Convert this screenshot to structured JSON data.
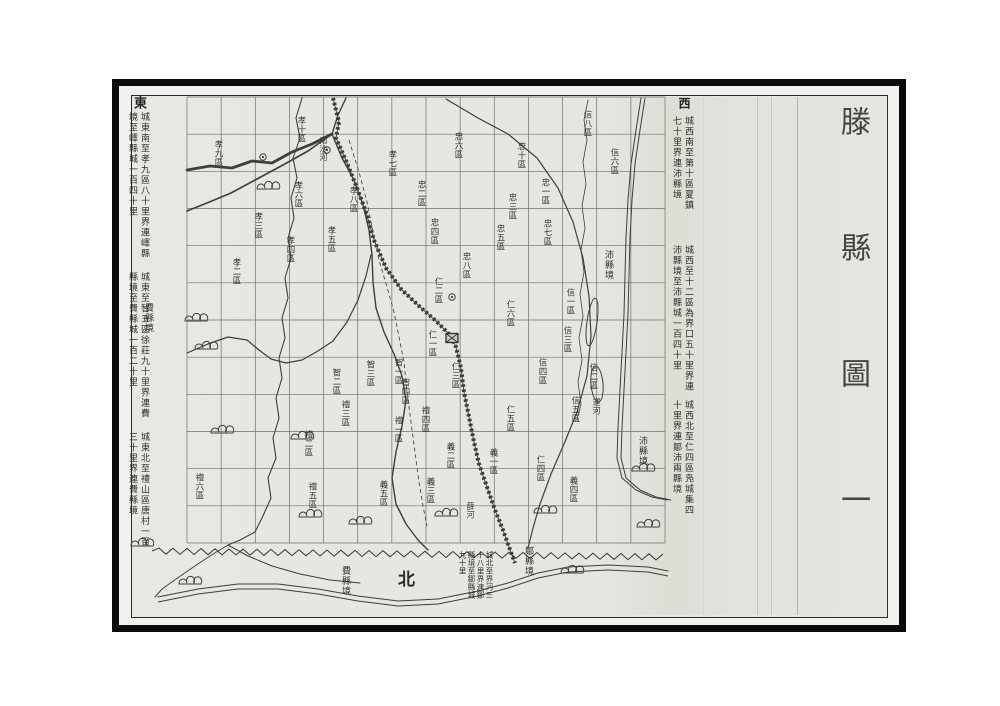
{
  "title": "滕縣圖一",
  "colors": {
    "paper": "#e8e6e1",
    "ink": "#3f3e3a",
    "grid": "#6f6e69",
    "frame": "#0b0b0b"
  },
  "margins": {
    "east": {
      "header": "東",
      "notes": [
        "城東南至孝九區八十里界連嶧縣境至嶧縣城一百四十里",
        "城東至智五區徐莊九十里界連費縣境至費縣城一百二十里",
        "城東北至禮山區唐村一百三十里界連費縣境"
      ]
    },
    "west": {
      "header": "西",
      "notes": [
        "城西南至第十區夏鎮七十里界連沛縣境",
        "城西至十二區為界口五十里界連沛縣境至沛縣城一百四十里",
        "城西北至仁四區凫城集四十里界連鄒沛兩縣境"
      ]
    }
  },
  "bottom": {
    "north": "北",
    "note": "城北至界河三十八里界連鄒縣境至鄒縣城九十里"
  },
  "map": {
    "grid": {
      "x0": 187,
      "y0": 97,
      "x1": 665,
      "y1": 543,
      "cols": 14,
      "rows": 12
    },
    "labels": {
      "district": [
        {
          "t": "孝十區",
          "x": 297,
          "y": 116
        },
        {
          "t": "孝九區",
          "x": 214,
          "y": 140
        },
        {
          "t": "孝六區",
          "x": 294,
          "y": 181
        },
        {
          "t": "孝三區",
          "x": 254,
          "y": 212
        },
        {
          "t": "孝四區",
          "x": 286,
          "y": 236
        },
        {
          "t": "孝八區",
          "x": 349,
          "y": 186
        },
        {
          "t": "孝七區",
          "x": 388,
          "y": 150
        },
        {
          "t": "孝五區",
          "x": 327,
          "y": 226
        },
        {
          "t": "孝二區",
          "x": 232,
          "y": 258
        },
        {
          "t": "忠六區",
          "x": 454,
          "y": 132
        },
        {
          "t": "忠十區",
          "x": 517,
          "y": 142
        },
        {
          "t": "忠二區",
          "x": 417,
          "y": 180
        },
        {
          "t": "忠一區",
          "x": 541,
          "y": 178
        },
        {
          "t": "忠三區",
          "x": 508,
          "y": 193
        },
        {
          "t": "忠四區",
          "x": 430,
          "y": 218
        },
        {
          "t": "忠五區",
          "x": 496,
          "y": 224
        },
        {
          "t": "忠七區",
          "x": 543,
          "y": 219
        },
        {
          "t": "忠八區",
          "x": 462,
          "y": 252
        },
        {
          "t": "信八區",
          "x": 583,
          "y": 110
        },
        {
          "t": "信六區",
          "x": 610,
          "y": 148
        },
        {
          "t": "信一區",
          "x": 566,
          "y": 288
        },
        {
          "t": "信三區",
          "x": 563,
          "y": 326
        },
        {
          "t": "信二區",
          "x": 589,
          "y": 363
        },
        {
          "t": "信四區",
          "x": 538,
          "y": 358
        },
        {
          "t": "信五區",
          "x": 571,
          "y": 396
        },
        {
          "t": "仁二區",
          "x": 434,
          "y": 277
        },
        {
          "t": "仁一區",
          "x": 428,
          "y": 330
        },
        {
          "t": "仁三區",
          "x": 451,
          "y": 362
        },
        {
          "t": "仁五區",
          "x": 506,
          "y": 405
        },
        {
          "t": "仁四區",
          "x": 536,
          "y": 455
        },
        {
          "t": "仁六區",
          "x": 506,
          "y": 300
        },
        {
          "t": "智一區",
          "x": 394,
          "y": 358
        },
        {
          "t": "智二區",
          "x": 332,
          "y": 368
        },
        {
          "t": "智三區",
          "x": 366,
          "y": 360
        },
        {
          "t": "智四區",
          "x": 401,
          "y": 378
        },
        {
          "t": "禮一區",
          "x": 394,
          "y": 416
        },
        {
          "t": "禮三區",
          "x": 341,
          "y": 400
        },
        {
          "t": "禮四區",
          "x": 421,
          "y": 406
        },
        {
          "t": "禮二區",
          "x": 304,
          "y": 430
        },
        {
          "t": "禮五區",
          "x": 308,
          "y": 482
        },
        {
          "t": "禮六區",
          "x": 195,
          "y": 473
        },
        {
          "t": "義一區",
          "x": 489,
          "y": 448
        },
        {
          "t": "義二區",
          "x": 446,
          "y": 442
        },
        {
          "t": "義三區",
          "x": 426,
          "y": 477
        },
        {
          "t": "義五區",
          "x": 379,
          "y": 480
        },
        {
          "t": "義四區",
          "x": 569,
          "y": 476
        }
      ],
      "place": [
        {
          "t": "南沙河",
          "x": 319,
          "y": 136
        },
        {
          "t": "運河",
          "x": 592,
          "y": 398
        },
        {
          "t": "薛河",
          "x": 466,
          "y": 502
        }
      ],
      "boundary": [
        {
          "t": "費縣境",
          "x": 144,
          "y": 303
        },
        {
          "t": "費縣境",
          "x": 341,
          "y": 566
        },
        {
          "t": "鄒縣境",
          "x": 524,
          "y": 546
        },
        {
          "t": "沛縣境",
          "x": 604,
          "y": 250
        },
        {
          "t": "沛縣境",
          "x": 638,
          "y": 436
        }
      ]
    },
    "rivers": [
      {
        "name": "east-wavy-river",
        "w": 1.1,
        "pts": [
          [
            302,
            98
          ],
          [
            296,
            118
          ],
          [
            300,
            138
          ],
          [
            293,
            158
          ],
          [
            297,
            178
          ],
          [
            291,
            198
          ],
          [
            294,
            218
          ],
          [
            288,
            238
          ],
          [
            291,
            258
          ],
          [
            285,
            278
          ],
          [
            288,
            298
          ],
          [
            282,
            318
          ],
          [
            285,
            338
          ],
          [
            279,
            358
          ],
          [
            282,
            378
          ],
          [
            276,
            398
          ],
          [
            279,
            418
          ],
          [
            273,
            438
          ],
          [
            276,
            458
          ],
          [
            268,
            478
          ],
          [
            271,
            498
          ],
          [
            262,
            518
          ],
          [
            255,
            532
          ],
          [
            240,
            540
          ],
          [
            228,
            545
          ]
        ]
      },
      {
        "name": "dark-top-river",
        "w": 2.8,
        "pts": [
          [
            187,
            170
          ],
          [
            210,
            166
          ],
          [
            232,
            168
          ],
          [
            252,
            161
          ],
          [
            272,
            163
          ],
          [
            292,
            152
          ],
          [
            312,
            144
          ],
          [
            332,
            134
          ]
        ]
      },
      {
        "name": "sw-branch",
        "w": 1.6,
        "pts": [
          [
            332,
            134
          ],
          [
            308,
            151
          ],
          [
            283,
            165
          ],
          [
            257,
            179
          ],
          [
            231,
            193
          ],
          [
            207,
            203
          ],
          [
            187,
            211
          ]
        ]
      },
      {
        "name": "top-entry",
        "w": 1.4,
        "pts": [
          [
            346,
            98
          ],
          [
            338,
            115
          ],
          [
            332,
            134
          ]
        ]
      },
      {
        "name": "main-south-river",
        "w": 1.4,
        "pts": [
          [
            332,
            134
          ],
          [
            342,
            158
          ],
          [
            354,
            180
          ],
          [
            363,
            205
          ],
          [
            369,
            230
          ],
          [
            372,
            255
          ],
          [
            373,
            282
          ],
          [
            376,
            308
          ],
          [
            384,
            332
          ],
          [
            394,
            354
          ],
          [
            402,
            376
          ],
          [
            406,
            400
          ],
          [
            402,
            426
          ],
          [
            396,
            452
          ],
          [
            392,
            478
          ],
          [
            396,
            504
          ],
          [
            406,
            524
          ],
          [
            418,
            540
          ],
          [
            428,
            550
          ]
        ]
      },
      {
        "name": "mid-horizontal-river",
        "w": 1.2,
        "pts": [
          [
            187,
            353
          ],
          [
            208,
            344
          ],
          [
            228,
            337
          ],
          [
            247,
            340
          ],
          [
            259,
            350
          ],
          [
            271,
            359
          ],
          [
            286,
            363
          ],
          [
            302,
            360
          ],
          [
            318,
            351
          ],
          [
            333,
            341
          ],
          [
            347,
            322
          ],
          [
            358,
            300
          ],
          [
            366,
            276
          ],
          [
            371,
            255
          ]
        ]
      },
      {
        "name": "big-right-curve",
        "w": 1.2,
        "pts": [
          [
            446,
            99
          ],
          [
            478,
            118
          ],
          [
            508,
            134
          ],
          [
            537,
            158
          ],
          [
            558,
            188
          ],
          [
            573,
            222
          ],
          [
            583,
            258
          ],
          [
            589,
            296
          ],
          [
            591,
            336
          ],
          [
            587,
            376
          ],
          [
            577,
            412
          ],
          [
            564,
            444
          ],
          [
            551,
            474
          ],
          [
            540,
            504
          ],
          [
            533,
            528
          ],
          [
            528,
            548
          ]
        ]
      },
      {
        "name": "canal",
        "w": 1.0,
        "double": 4,
        "pts": [
          [
            641,
            98
          ],
          [
            636,
            130
          ],
          [
            631,
            164
          ],
          [
            628,
            200
          ],
          [
            626,
            238
          ],
          [
            625,
            276
          ],
          [
            624,
            314
          ],
          [
            622,
            352
          ],
          [
            620,
            390
          ],
          [
            618,
            428
          ],
          [
            617,
            458
          ],
          [
            622,
            478
          ],
          [
            636,
            490
          ],
          [
            652,
            497
          ],
          [
            667,
            500
          ]
        ]
      },
      {
        "name": "lake-shore",
        "w": 0.8,
        "pts": [
          [
            588,
            100
          ],
          [
            584,
            120
          ],
          [
            587,
            140
          ],
          [
            583,
            162
          ],
          [
            586,
            184
          ],
          [
            582,
            206
          ],
          [
            585,
            228
          ],
          [
            581,
            250
          ],
          [
            584,
            272
          ],
          [
            580,
            294
          ],
          [
            583,
            316
          ],
          [
            579,
            338
          ],
          [
            582,
            360
          ],
          [
            578,
            382
          ],
          [
            581,
            404
          ],
          [
            577,
            420
          ]
        ]
      },
      {
        "name": "border-river",
        "w": 1.0,
        "double": 5,
        "pts": [
          [
            158,
            597
          ],
          [
            198,
            589
          ],
          [
            238,
            584
          ],
          [
            278,
            584
          ],
          [
            318,
            589
          ],
          [
            358,
            596
          ],
          [
            398,
            601
          ],
          [
            438,
            599
          ],
          [
            478,
            591
          ],
          [
            508,
            583
          ],
          [
            538,
            573
          ],
          [
            568,
            567
          ],
          [
            608,
            565
          ],
          [
            648,
            567
          ],
          [
            668,
            571
          ]
        ]
      },
      {
        "name": "fork-west",
        "w": 1.0,
        "pts": [
          [
            228,
            545
          ],
          [
            210,
            556
          ],
          [
            192,
            568
          ],
          [
            176,
            579
          ],
          [
            162,
            589
          ],
          [
            155,
            597
          ]
        ]
      },
      {
        "name": "fork-east",
        "w": 1.0,
        "pts": [
          [
            228,
            545
          ],
          [
            248,
            556
          ],
          [
            272,
            566
          ],
          [
            300,
            574
          ],
          [
            330,
            580
          ],
          [
            360,
            583
          ]
        ]
      }
    ],
    "railway": [
      [
        333,
        98
      ],
      [
        339,
        122
      ],
      [
        336,
        138
      ],
      [
        347,
        163
      ],
      [
        357,
        188
      ],
      [
        366,
        212
      ],
      [
        374,
        240
      ],
      [
        386,
        268
      ],
      [
        401,
        289
      ],
      [
        419,
        306
      ],
      [
        436,
        321
      ],
      [
        449,
        334
      ],
      [
        456,
        347
      ],
      [
        461,
        368
      ],
      [
        464,
        392
      ],
      [
        469,
        417
      ],
      [
        474,
        442
      ],
      [
        479,
        464
      ],
      [
        487,
        487
      ],
      [
        495,
        510
      ],
      [
        503,
        530
      ],
      [
        509,
        547
      ],
      [
        515,
        563
      ]
    ],
    "road": [
      [
        349,
        140
      ],
      [
        359,
        172
      ],
      [
        367,
        202
      ],
      [
        373,
        232
      ],
      [
        379,
        260
      ],
      [
        387,
        287
      ],
      [
        394,
        312
      ],
      [
        399,
        337
      ],
      [
        404,
        362
      ],
      [
        407,
        392
      ],
      [
        411,
        422
      ],
      [
        415,
        452
      ],
      [
        419,
        482
      ],
      [
        423,
        506
      ],
      [
        427,
        526
      ]
    ],
    "zigzag": {
      "x0": 152,
      "y0": 551,
      "x1": 668,
      "y1": 557,
      "step": 7,
      "amp": 3
    },
    "lakes": [
      {
        "cx": 592,
        "cy": 322,
        "rx": 5,
        "ry": 24,
        "rot": 8
      },
      {
        "cx": 597,
        "cy": 384,
        "rx": 6,
        "ry": 18,
        "rot": -5
      }
    ],
    "symbols": {
      "mountains": [
        [
          268,
          186
        ],
        [
          196,
          318
        ],
        [
          206,
          346
        ],
        [
          222,
          430
        ],
        [
          302,
          436
        ],
        [
          142,
          543
        ],
        [
          190,
          581
        ],
        [
          310,
          514
        ],
        [
          360,
          521
        ],
        [
          446,
          513
        ],
        [
          572,
          570
        ],
        [
          545,
          510
        ],
        [
          643,
          468
        ],
        [
          648,
          524
        ]
      ],
      "towns": [
        [
          327,
          150
        ],
        [
          263,
          157
        ],
        [
          452,
          297
        ]
      ],
      "city": [
        452,
        338
      ]
    }
  },
  "icons": {
    "mountain-icon": "three-bump rock cluster",
    "town-circle-icon": "small double circle",
    "county-city-icon": "hatched walled-city square",
    "railway-line": "hatched double line",
    "boundary-zigzag": "sawtooth county border"
  }
}
